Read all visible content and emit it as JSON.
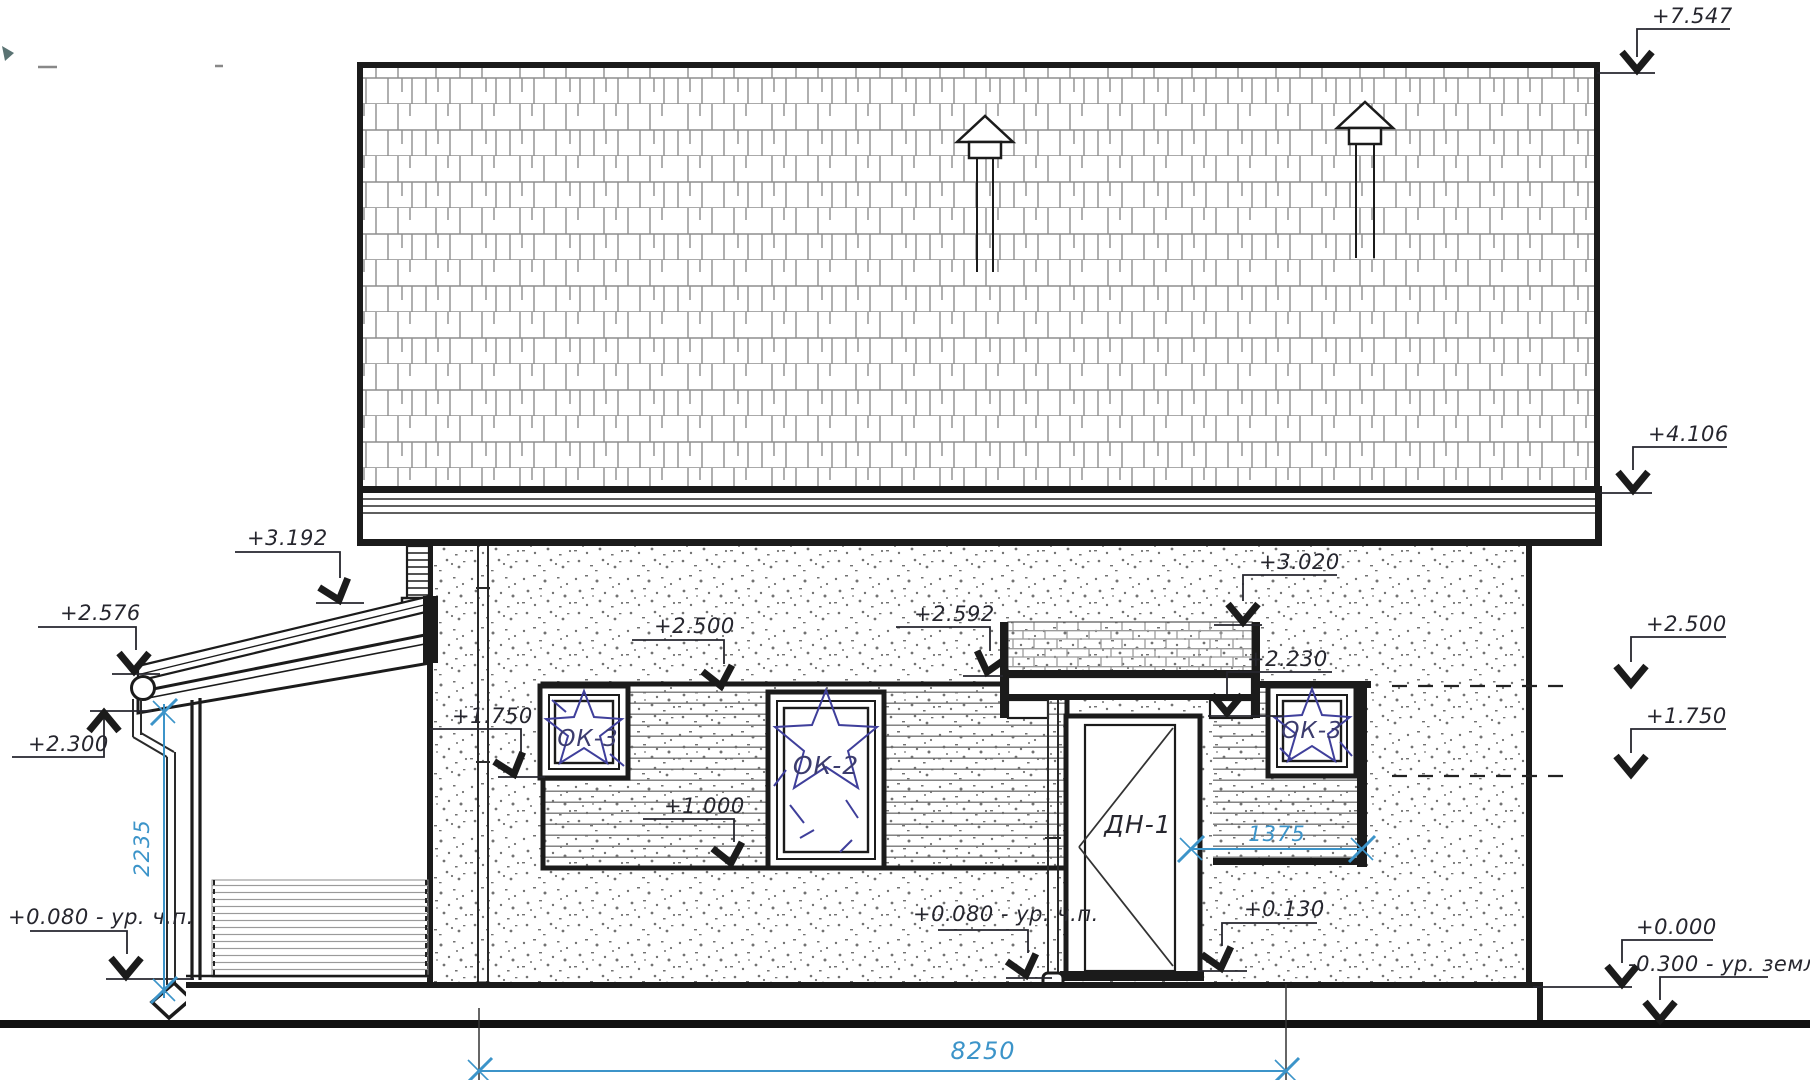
{
  "drawing": {
    "type": "building-front-elevation",
    "line_color": "#1b1b1b",
    "dim_color": "#3c94c9",
    "glass_color": "#3f3f9b",
    "elevation_marks": [
      {
        "id": "mark-7547",
        "label": "+7.547",
        "text": [
          1652,
          23
        ],
        "pts": [
          [
            1730,
            29
          ],
          [
            1637,
            29
          ],
          [
            1637,
            57
          ]
        ],
        "arrow": [
          1637,
          70,
          0
        ],
        "ext": [
          1597,
          73,
          1655,
          73
        ]
      },
      {
        "id": "mark-4106",
        "label": "+4.106",
        "text": [
          1648,
          441
        ],
        "pts": [
          [
            1727,
            447
          ],
          [
            1633,
            447
          ],
          [
            1633,
            470
          ]
        ],
        "arrow": [
          1633,
          490,
          0
        ],
        "ext": [
          1600,
          493,
          1652,
          493
        ]
      },
      {
        "id": "mark-3192",
        "label": "+3.192",
        "text": [
          247,
          545
        ],
        "pts": [
          [
            235,
            552
          ],
          [
            340,
            552
          ],
          [
            340,
            578
          ]
        ],
        "arrow": [
          339,
          600,
          -18
        ],
        "ext": [
          316,
          603,
          364,
          603
        ]
      },
      {
        "id": "mark-2576",
        "label": "+2.576",
        "text": [
          60,
          620
        ],
        "pts": [
          [
            38,
            627
          ],
          [
            136,
            627
          ],
          [
            136,
            650
          ]
        ],
        "arrow": [
          134,
          671,
          0
        ],
        "ext": [
          112,
          674,
          160,
          674
        ]
      },
      {
        "id": "mark-2300",
        "label": "+2.300",
        "text": [
          28,
          751
        ],
        "pts": [
          [
            12,
            757
          ],
          [
            104,
            757
          ],
          [
            104,
            715
          ]
        ],
        "arrow": [
          104,
          713,
          180
        ],
        "ext": [
          90,
          711,
          152,
          711
        ]
      },
      {
        "id": "mark-2500-left",
        "label": "+2.500",
        "text": [
          654,
          633
        ],
        "pts": [
          [
            632,
            640
          ],
          [
            724,
            640
          ],
          [
            724,
            664
          ]
        ],
        "arrow": [
          721,
          686,
          -12
        ],
        "ext": null
      },
      {
        "id": "mark-1750-left",
        "label": "+1.750",
        "text": [
          452,
          723
        ],
        "pts": [
          [
            430,
            729
          ],
          [
            521,
            729
          ],
          [
            521,
            752
          ]
        ],
        "arrow": [
          514,
          774,
          -18
        ],
        "ext": [
          498,
          777,
          545,
          777
        ]
      },
      {
        "id": "mark-1000",
        "label": "+1.000",
        "text": [
          664,
          813
        ],
        "pts": [
          [
            643,
            819
          ],
          [
            734,
            819
          ],
          [
            734,
            842
          ]
        ],
        "arrow": [
          731,
          863,
          -12
        ],
        "ext": null
      },
      {
        "id": "mark-2592",
        "label": "+2.592",
        "text": [
          914,
          621
        ],
        "pts": [
          [
            896,
            627
          ],
          [
            990,
            627
          ],
          [
            990,
            651
          ]
        ],
        "arrow": [
          987,
          672,
          15
        ],
        "ext": [
          963,
          676,
          1003,
          676
        ]
      },
      {
        "id": "mark-3020",
        "label": "+3.020",
        "text": [
          1259,
          569
        ],
        "pts": [
          [
            1337,
            575
          ],
          [
            1243,
            575
          ],
          [
            1243,
            601
          ]
        ],
        "arrow": [
          1243,
          622,
          0
        ],
        "ext": [
          1214,
          625,
          1262,
          625
        ]
      },
      {
        "id": "mark-2230",
        "label": "+2.230",
        "text": [
          1247,
          666
        ],
        "pts": [
          [
            1332,
            672
          ],
          [
            1227,
            672
          ],
          [
            1227,
            694
          ]
        ],
        "arrow": [
          1227,
          713,
          0
        ],
        "ext": [
          1208,
          716,
          1284,
          716
        ]
      },
      {
        "id": "mark-2500-right",
        "label": "+2.500",
        "text": [
          1646,
          631
        ],
        "pts": [
          [
            1726,
            637
          ],
          [
            1631,
            637
          ],
          [
            1631,
            662
          ]
        ],
        "arrow": [
          1631,
          684,
          0
        ],
        "ext": null
      },
      {
        "id": "mark-1750-right",
        "label": "+1.750",
        "text": [
          1646,
          723
        ],
        "pts": [
          [
            1726,
            729
          ],
          [
            1631,
            729
          ],
          [
            1631,
            753
          ]
        ],
        "arrow": [
          1631,
          774,
          0
        ],
        "ext": null
      },
      {
        "id": "mark-0080-left",
        "label": "+0.080 - ур. ч.п.",
        "text": [
          8,
          924
        ],
        "pts": [
          [
            30,
            931
          ],
          [
            127,
            931
          ],
          [
            127,
            954
          ]
        ],
        "arrow": [
          126,
          976,
          0
        ],
        "ext": [
          106,
          979,
          194,
          979
        ]
      },
      {
        "id": "mark-0080-mid",
        "label": "+0.080 - ур. ч.п.",
        "text": [
          913,
          921
        ],
        "pts": [
          [
            938,
            930
          ],
          [
            1028,
            930
          ],
          [
            1028,
            953
          ]
        ],
        "arrow": [
          1026,
          975,
          -15
        ],
        "ext": [
          1006,
          978,
          1052,
          978
        ]
      },
      {
        "id": "mark-0130",
        "label": "+0.130",
        "text": [
          1244,
          916
        ],
        "pts": [
          [
            1317,
            923
          ],
          [
            1222,
            923
          ],
          [
            1222,
            946
          ]
        ],
        "arrow": [
          1221,
          968,
          -15
        ],
        "ext": [
          1198,
          971,
          1247,
          971
        ]
      },
      {
        "id": "mark-0000",
        "label": "+0.000",
        "text": [
          1636,
          934
        ],
        "pts": [
          [
            1713,
            940
          ],
          [
            1622,
            940
          ],
          [
            1622,
            963
          ]
        ],
        "arrow": [
          1622,
          984,
          0
        ],
        "ext": [
          1533,
          987,
          1632,
          987
        ]
      },
      {
        "id": "mark-0300",
        "label": "-0.300 - ур. земли",
        "text": [
          1628,
          971
        ],
        "pts": [
          [
            1768,
            977
          ],
          [
            1660,
            977
          ],
          [
            1660,
            1000
          ]
        ],
        "arrow": [
          1660,
          1020,
          0
        ],
        "ext": null
      }
    ],
    "dimensions": [
      {
        "id": "dim-8250",
        "label": "8250",
        "orient": "h",
        "line": [
          479,
          1071,
          1286,
          1071
        ],
        "text": [
          983,
          1059
        ],
        "size": 24,
        "ticks": [
          [
            479,
            1071
          ],
          [
            1286,
            1071
          ]
        ],
        "extensions": [
          [
            479,
            1008,
            479,
            1082
          ],
          [
            1286,
            984,
            1286,
            1082
          ]
        ]
      },
      {
        "id": "dim-1375",
        "label": "1375",
        "orient": "h",
        "line": [
          1191,
          849,
          1362,
          849
        ],
        "text": [
          1277,
          841
        ],
        "size": 21,
        "ticks": [
          [
            1191,
            849
          ],
          [
            1362,
            849
          ]
        ],
        "extensions": []
      },
      {
        "id": "dim-2235",
        "label": "2235",
        "orient": "v",
        "line": [
          164,
          704,
          164,
          998
        ],
        "text": [
          149,
          848
        ],
        "size": 21,
        "ticks": [
          [
            164,
            712
          ],
          [
            164,
            990
          ]
        ],
        "extensions": []
      }
    ],
    "component_labels": [
      {
        "id": "window-ok3-left-label",
        "label": "ОК-3",
        "x": 588,
        "y": 746,
        "size": 23,
        "color": "#3c3c6e"
      },
      {
        "id": "window-ok2-label",
        "label": "ОК-2",
        "x": 826,
        "y": 774,
        "size": 25,
        "color": "#3c3c6e"
      },
      {
        "id": "window-ok3-right-label",
        "label": "ОК-3",
        "x": 1312,
        "y": 738,
        "size": 23,
        "color": "#3c3c6e"
      },
      {
        "id": "door-dn1-label",
        "label": "ДН-1",
        "x": 1138,
        "y": 833,
        "size": 25,
        "color": "#26262e"
      }
    ]
  }
}
